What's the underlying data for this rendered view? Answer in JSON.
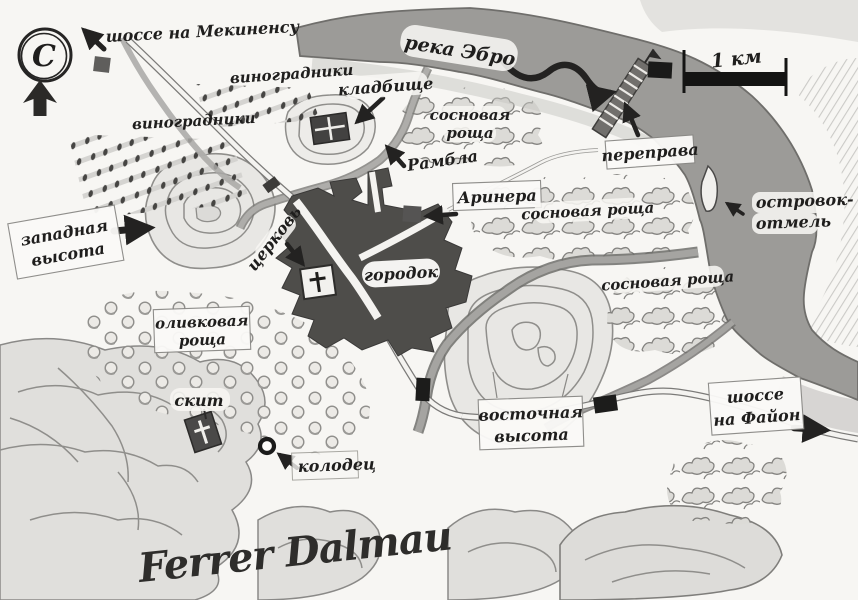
{
  "map": {
    "compass": {
      "letter": "С"
    },
    "scale": {
      "label": "1 км"
    },
    "signature": "Ferrer Dalmau",
    "labels": {
      "mequinenza": "шоссе на Мекиненсу",
      "vineyards_top": "виноградники",
      "vineyards_left": "виноградники",
      "cemetery": "кладбище",
      "river": "река Эбро",
      "pine_north": {
        "line1": "сосновая",
        "line2": "роща"
      },
      "crossing": "переправа",
      "islet": {
        "line1": "островок-",
        "line2": "отмель"
      },
      "rambla": "Рамбла",
      "arinera": "Аринера",
      "west_height": {
        "line1": "западная",
        "line2": "высота"
      },
      "church": "церковь",
      "town": "городок",
      "pine_mid": "сосновая роща",
      "pine_south": "сосновая роща",
      "olive": {
        "line1": "оливковая",
        "line2": "роща"
      },
      "hermitage": "скит",
      "well": "колодец",
      "east_height": {
        "line1": "восточная",
        "line2": "высота"
      },
      "fayon": {
        "line1": "шоссе",
        "line2": "на Файон"
      }
    },
    "colors": {
      "paper": "#f7f6f3",
      "river": "#9c9b98",
      "town": "#4e4d4a",
      "ink": "#1f1e1d",
      "hill_fill": "#e7e6e3",
      "contour": "#8f8e8b"
    }
  }
}
